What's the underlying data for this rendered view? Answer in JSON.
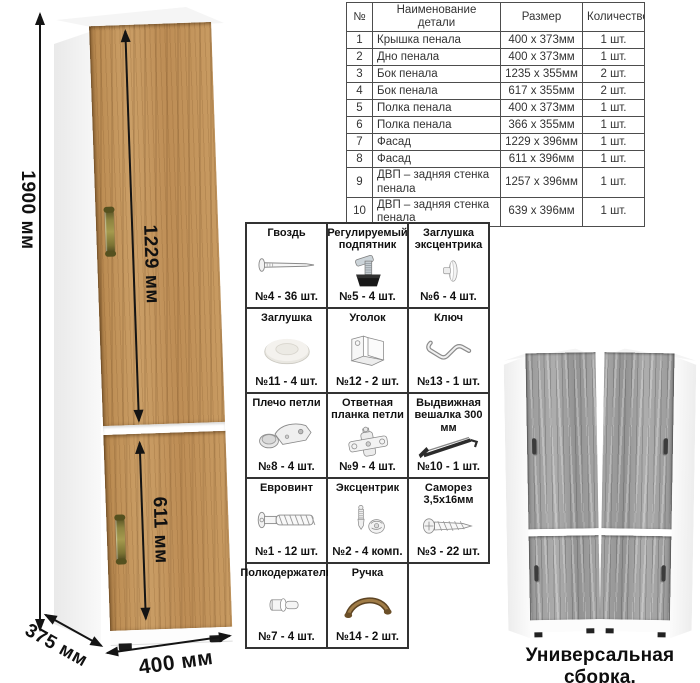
{
  "drawing": {
    "height_label": "1900 мм",
    "upper_door_label": "1229 мм",
    "lower_door_label": "611 мм",
    "depth_label": "375 мм",
    "width_label": "400 мм"
  },
  "parts_table": {
    "headers": [
      "№",
      "Наименование детали",
      "Размер",
      "Количество"
    ],
    "rows": [
      [
        "1",
        "Крышка пенала",
        "400 х 373мм",
        "1 шт."
      ],
      [
        "2",
        "Дно пенала",
        "400 х 373мм",
        "1 шт."
      ],
      [
        "3",
        "Бок пенала",
        "1235 х 355мм",
        "2 шт."
      ],
      [
        "4",
        "Бок пенала",
        "617 х 355мм",
        "2 шт."
      ],
      [
        "5",
        "Полка пенала",
        "400 х 373мм",
        "1 шт."
      ],
      [
        "6",
        "Полка пенала",
        "366 х 355мм",
        "1 шт."
      ],
      [
        "7",
        "Фасад",
        "1229 х 396мм",
        "1 шт."
      ],
      [
        "8",
        "Фасад",
        "611 х 396мм",
        "1 шт."
      ],
      [
        "9",
        "ДВП – задняя стенка пенала",
        "1257 х 396мм",
        "1 шт."
      ],
      [
        "10",
        "ДВП – задняя стенка пенала",
        "639 х 396мм",
        "1 шт."
      ]
    ]
  },
  "hardware": {
    "items": [
      {
        "title": "Гвоздь",
        "qty": "№4 - 36 шт.",
        "icon": "nail-icon"
      },
      {
        "title": "Регулируемый подпятник",
        "qty": "№5 - 4 шт.",
        "icon": "adjustable-foot-icon"
      },
      {
        "title": "Заглушка эксцентрика",
        "qty": "№6 - 4 шт.",
        "icon": "cam-cap-icon"
      },
      {
        "title": "Заглушка",
        "qty": "№11 - 4 шт.",
        "icon": "round-cap-icon"
      },
      {
        "title": "Уголок",
        "qty": "№12 - 2 шт.",
        "icon": "corner-bracket-icon"
      },
      {
        "title": "Ключ",
        "qty": "№13 - 1 шт.",
        "icon": "hex-key-icon"
      },
      {
        "title": "Плечо петли",
        "qty": "№8 - 4 шт.",
        "icon": "hinge-arm-icon"
      },
      {
        "title": "Ответная планка петли",
        "qty": "№9 - 4 шт.",
        "icon": "hinge-plate-icon"
      },
      {
        "title": "Выдвижная вешалка 300 мм",
        "qty": "№10 - 1 шт.",
        "icon": "pullout-hanger-icon"
      },
      {
        "title": "Евровинт",
        "qty": "№1 - 12 шт.",
        "icon": "euro-screw-icon"
      },
      {
        "title": "Эксцентрик",
        "qty": "№2 - 4 комп.",
        "icon": "cam-lock-icon"
      },
      {
        "title": "Саморез 3,5х16мм",
        "qty": "№3 - 22 шт.",
        "icon": "self-tapping-screw-icon"
      },
      {
        "title": "Полкодержатель",
        "qty": "№7 - 4 шт.",
        "icon": "shelf-pin-icon"
      },
      {
        "title": "Ручка",
        "qty": "№14 - 2 шт.",
        "icon": "handle-icon"
      }
    ]
  },
  "footer": {
    "caption": "Универсальная сборка."
  },
  "colors": {
    "wood": "#c2915a",
    "gray_wood": "#a2a2a2",
    "handle_bronze": "#8d8440",
    "line": "#141414"
  }
}
